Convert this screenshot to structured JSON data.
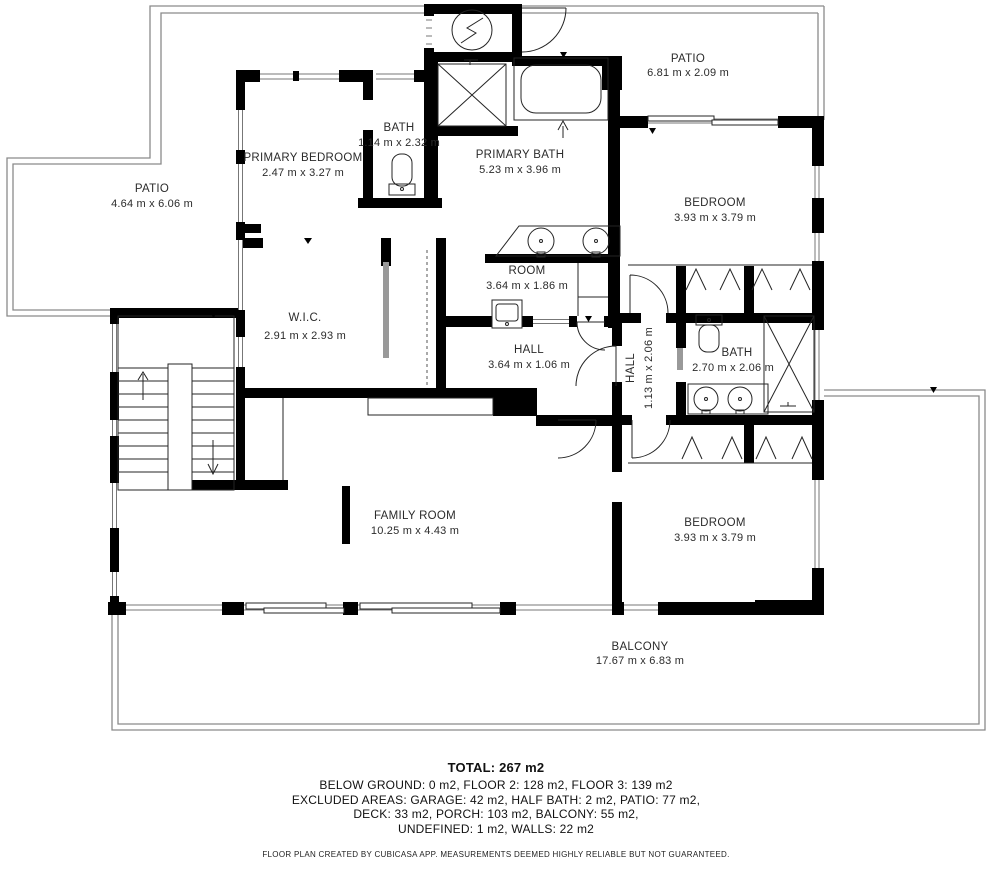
{
  "meta": {
    "app_attribution": "CubiCasa",
    "plan_type": "floor-plan"
  },
  "colors": {
    "wall": "#000000",
    "outdoor_line": "#8a8a8a",
    "text": "#2b2b2b",
    "background": "#ffffff"
  },
  "rooms": [
    {
      "name": "PATIO",
      "dims": "6.81 m x 2.09 m"
    },
    {
      "name": "PATIO",
      "dims": "4.64 m x 6.06 m"
    },
    {
      "name": "BATH",
      "dims": "1.14 m x 2.32 m"
    },
    {
      "name": "PRIMARY BEDROOM",
      "dims": "2.47 m x 3.27 m"
    },
    {
      "name": "PRIMARY BATH",
      "dims": "5.23 m x 3.96 m"
    },
    {
      "name": "BEDROOM",
      "dims": "3.93 m x 3.79 m"
    },
    {
      "name": "ROOM",
      "dims": "3.64 m x 1.86 m"
    },
    {
      "name": "W.I.C.",
      "dims": "2.91 m x 2.93 m"
    },
    {
      "name": "HALL",
      "dims": "3.64 m x 1.06 m"
    },
    {
      "name": "HALL",
      "dims": "1.13 m x 2.06 m"
    },
    {
      "name": "BATH",
      "dims": "2.70 m x 2.06 m"
    },
    {
      "name": "BEDROOM",
      "dims": "3.93 m x 3.79 m"
    },
    {
      "name": "FAMILY ROOM",
      "dims": "10.25 m x 4.43 m"
    },
    {
      "name": "BALCONY",
      "dims": "17.67 m x 6.83 m"
    }
  ],
  "footer": {
    "total": "TOTAL: 267 m2",
    "lines": [
      "BELOW GROUND: 0 m2, FLOOR 2: 128 m2, FLOOR 3: 139 m2",
      "EXCLUDED AREAS: GARAGE: 42 m2, HALF BATH: 2 m2, PATIO: 77 m2,",
      "DECK: 33 m2, PORCH: 103 m2, BALCONY: 55 m2,",
      "UNDEFINED: 1 m2, WALLS: 22 m2"
    ],
    "disclaimer": "FLOOR PLAN CREATED BY CUBICASA APP. MEASUREMENTS DEEMED HIGHLY RELIABLE BUT NOT GUARANTEED."
  }
}
